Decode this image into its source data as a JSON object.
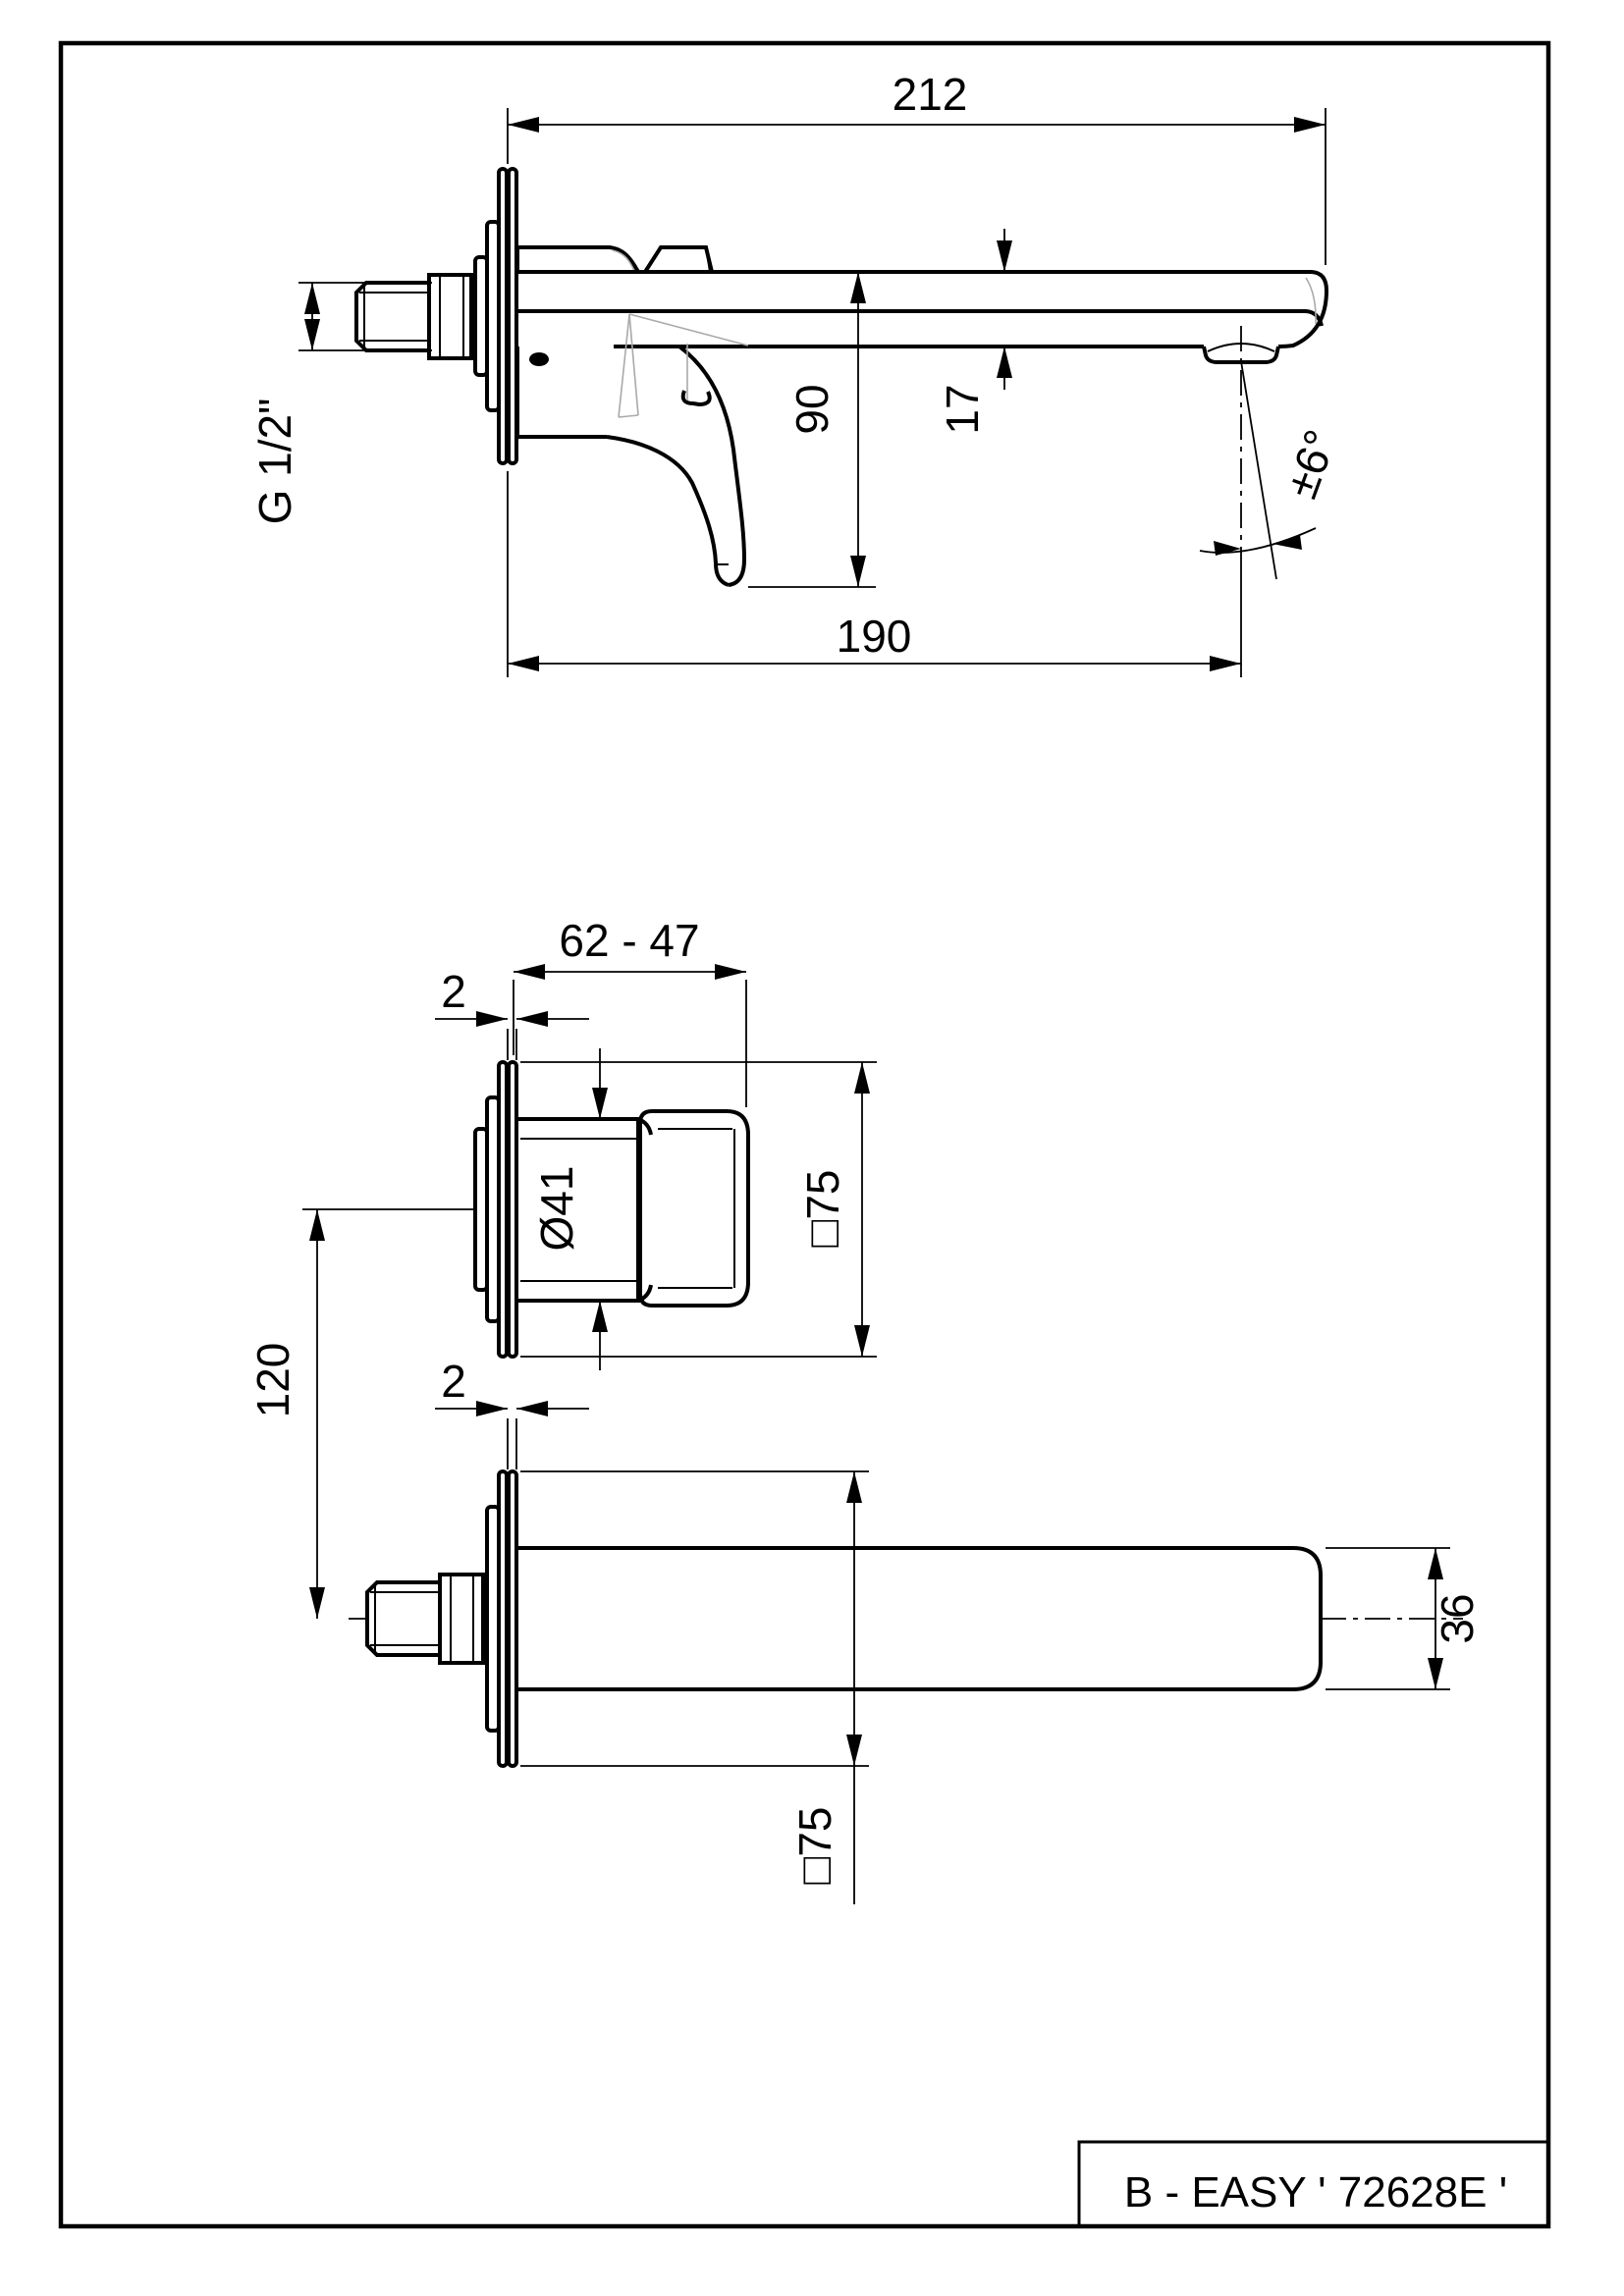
{
  "drawing": {
    "model_label": "B - EASY ' 72628E '",
    "top_view": {
      "overall_length": "212",
      "height_below_spout": "90",
      "spout_thickness": "17",
      "spout_projection": "190",
      "swivel_angle": "±6°",
      "inlet_thread": "G 1/2\""
    },
    "middle_view": {
      "mounting_depth_range": "62 - 47",
      "plate_thickness": "2",
      "body_diameter": "Ø41",
      "plate_size": "□75"
    },
    "bottom_view": {
      "center_distance": "120",
      "plate_thickness": "2",
      "spout_width": "36",
      "plate_size": "□75"
    }
  }
}
